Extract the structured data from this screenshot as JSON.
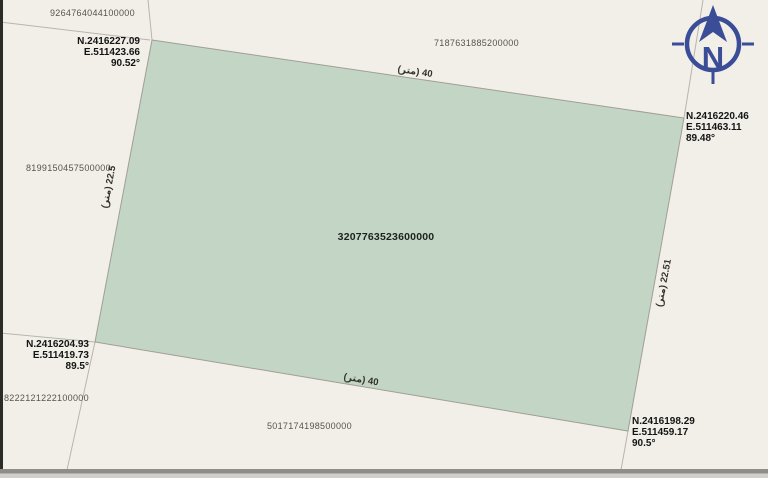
{
  "map": {
    "background_color": "#f1efe8",
    "parcel_fill_color": "#c3d5c5",
    "parcel_stroke_color": "#a09e96",
    "boundary_line_color": "#b7b5ae",
    "compass_color": "#3a4d96"
  },
  "compass": {
    "north_label": "N"
  },
  "parcel": {
    "id": "3207763523600000",
    "corners": {
      "top_left": {
        "n": "N.2416227.09",
        "e": "E.511423.66",
        "angle": "90.52°"
      },
      "top_right": {
        "n": "N.2416220.46",
        "e": "E.511463.11",
        "angle": "89.48°"
      },
      "bottom_left": {
        "n": "N.2416204.93",
        "e": "E.511419.73",
        "angle": "89.5°"
      },
      "bottom_right": {
        "n": "N.2416198.29",
        "e": "E.511459.17",
        "angle": "90.5°"
      }
    },
    "edges": {
      "top": "40 (متر)",
      "bottom": "40 (متر)",
      "left": "22.5 (متر)",
      "right": "22.51 (متر)"
    }
  },
  "neighbors": {
    "top_left": "9264764044100000",
    "top": "7187631885200000",
    "left": "8199150457500000",
    "bottom_left": "8222121222100000",
    "bottom": "5017174198500000"
  }
}
